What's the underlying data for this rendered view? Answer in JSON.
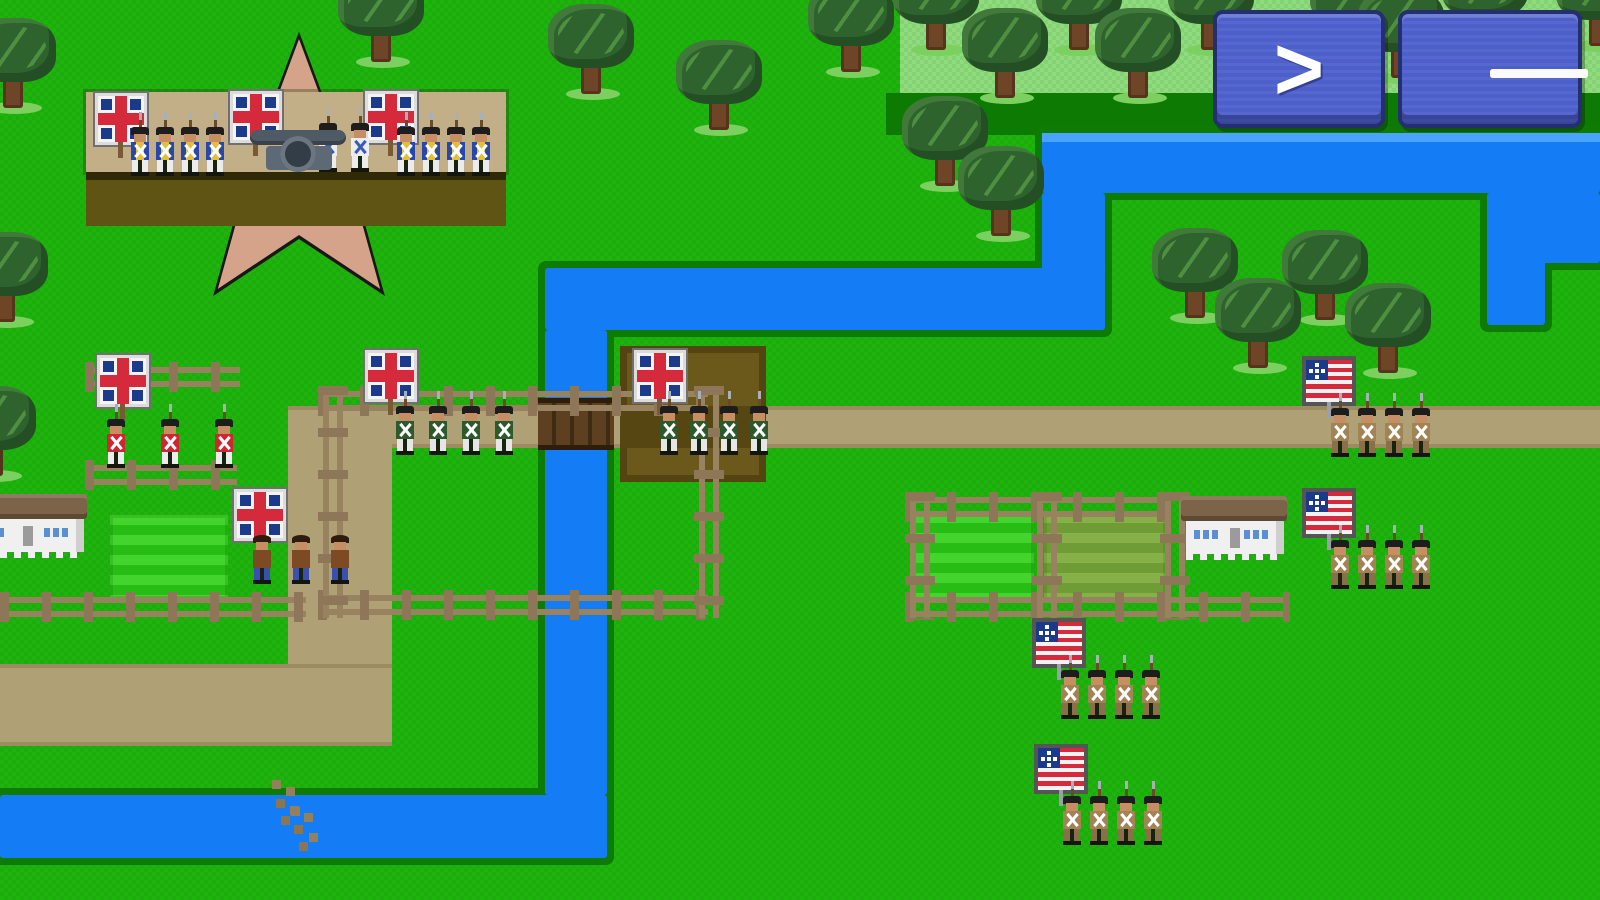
{
  "app": {
    "kind": "pixel-art-strategy-wargame",
    "view": "battle-map"
  },
  "hud": {
    "end_turn_button": {
      "icon": "chevron-right-icon",
      "glyph": ">"
    },
    "menu_button": {
      "icon": "hamburger-menu-icon",
      "bars": 3
    }
  },
  "colors": {
    "grass": "#1eb40d",
    "plateau": "#8fdb7d",
    "shadow": "#0d7a04",
    "water": "#147df5",
    "water_edge": "#0e7b05",
    "water_highlight": "#4aa4ff",
    "road": "#b0a075",
    "accent_button": "#4c5fca",
    "flag_red": "#d42a3c",
    "flag_blue": "#1b3a8c",
    "fort_star": "#d4a389",
    "fort_wall": "#c2ae87"
  },
  "map": {
    "width": 1600,
    "height": 900,
    "plateau": {
      "x": 900,
      "y": 0,
      "w": 700,
      "h": 93
    },
    "shadow_band": {
      "x": 886,
      "y": 93,
      "w": 714,
      "h": 42
    },
    "rivers": [
      {
        "x": 1042,
        "y": 133,
        "w": 558,
        "h": 60,
        "lip": true
      },
      {
        "x": 1487,
        "y": 193,
        "w": 58,
        "h": 132
      },
      {
        "x": 1540,
        "y": 193,
        "w": 60,
        "h": 70
      },
      {
        "x": 1042,
        "y": 193,
        "w": 63,
        "h": 137
      },
      {
        "x": 545,
        "y": 268,
        "w": 560,
        "h": 62
      },
      {
        "x": 545,
        "y": 330,
        "w": 62,
        "h": 465
      },
      {
        "x": 0,
        "y": 795,
        "w": 607,
        "h": 63
      }
    ],
    "roads": [
      {
        "x": 288,
        "y": 406,
        "w": 1312,
        "h": 42
      },
      {
        "x": 288,
        "y": 406,
        "w": 104,
        "h": 340
      },
      {
        "x": 0,
        "y": 664,
        "w": 392,
        "h": 82
      }
    ],
    "bridge": {
      "x": 538,
      "y": 398,
      "w": 76,
      "h": 52
    },
    "entrenchment": {
      "x": 620,
      "y": 346,
      "w": 146,
      "h": 136,
      "road_strip_y": 60,
      "road_strip_h": 42
    },
    "ford_marks": [
      {
        "x": 272,
        "y": 780
      },
      {
        "x": 290,
        "y": 806
      }
    ],
    "fields": [
      {
        "x": 110,
        "y": 515,
        "w": 118,
        "h": 84,
        "kind": "crop"
      },
      {
        "x": 912,
        "y": 513,
        "w": 122,
        "h": 88,
        "kind": "crop"
      },
      {
        "x": 1044,
        "y": 513,
        "w": 122,
        "h": 88,
        "kind": "olive"
      }
    ],
    "fences": [
      {
        "o": "h",
        "x": 85,
        "y": 362,
        "len": 155
      },
      {
        "o": "h",
        "x": 85,
        "y": 460,
        "len": 152
      },
      {
        "o": "h",
        "x": 0,
        "y": 592,
        "len": 306
      },
      {
        "o": "h",
        "x": 318,
        "y": 386,
        "len": 390
      },
      {
        "o": "h",
        "x": 318,
        "y": 590,
        "len": 390
      },
      {
        "o": "v",
        "x": 318,
        "y": 386,
        "len": 232
      },
      {
        "o": "v",
        "x": 694,
        "y": 386,
        "len": 232
      },
      {
        "o": "h",
        "x": 905,
        "y": 492,
        "len": 265
      },
      {
        "o": "h",
        "x": 905,
        "y": 592,
        "len": 385
      },
      {
        "o": "v",
        "x": 905,
        "y": 492,
        "len": 128
      },
      {
        "o": "v",
        "x": 1032,
        "y": 492,
        "len": 128
      },
      {
        "o": "v",
        "x": 1160,
        "y": 492,
        "len": 128
      }
    ],
    "houses": [
      {
        "x": -28,
        "y": 498,
        "w": 112,
        "h": 54,
        "roof": "#938672"
      },
      {
        "x": 1186,
        "y": 500,
        "w": 98,
        "h": 54,
        "roof": "#7d6347"
      }
    ],
    "trees": [
      [
        -30,
        18
      ],
      [
        338,
        -28
      ],
      [
        548,
        4
      ],
      [
        676,
        40
      ],
      [
        808,
        -18
      ],
      [
        893,
        -40
      ],
      [
        962,
        8
      ],
      [
        1036,
        -40
      ],
      [
        1095,
        8
      ],
      [
        1168,
        -40
      ],
      [
        1310,
        -38
      ],
      [
        1358,
        -12
      ],
      [
        1442,
        -46
      ],
      [
        1556,
        -44
      ],
      [
        902,
        96
      ],
      [
        958,
        146
      ],
      [
        1152,
        228
      ],
      [
        1282,
        230
      ],
      [
        1215,
        278
      ],
      [
        1345,
        283
      ],
      [
        -38,
        232
      ],
      [
        -50,
        386
      ]
    ],
    "fort": {
      "star_outline": {
        "x": 153,
        "y": 20,
        "size": 292
      },
      "star": {
        "x": 161,
        "y": 28,
        "size": 276
      },
      "band_top": {
        "x": 86,
        "y": 92,
        "w": 420,
        "h": 80
      },
      "band_line": {
        "x": 86,
        "y": 172,
        "w": 420,
        "h": 8
      },
      "band_low": {
        "x": 86,
        "y": 180,
        "w": 420,
        "h": 46
      },
      "flags": [
        [
          98,
          96
        ],
        [
          233,
          94
        ],
        [
          368,
          94
        ]
      ],
      "garrison_rows": [
        {
          "x": 128,
          "y": 112,
          "count": 4,
          "coat": "blue",
          "sp": 25
        },
        {
          "x": 394,
          "y": 112,
          "count": 4,
          "coat": "blue",
          "sp": 25
        }
      ],
      "crew": [
        {
          "x": 316,
          "y": 108,
          "coat": "white"
        },
        {
          "x": 348,
          "y": 108,
          "coat": "white"
        }
      ],
      "cannon": {
        "x": 250,
        "y": 124
      }
    },
    "units": [
      {
        "id": "british-redcoats",
        "faction": "british",
        "flag": "gb",
        "coat": "red",
        "count": 3,
        "x": 100,
        "y": 358,
        "sdx": 4,
        "sdy": 46,
        "sp": 54
      },
      {
        "id": "british-light-west",
        "faction": "british",
        "flag": "gb",
        "coat": "green",
        "count": 4,
        "x": 368,
        "y": 353,
        "sdx": 25,
        "sdy": 38,
        "sp": 33
      },
      {
        "id": "british-light-entrenched",
        "faction": "british",
        "flag": "gb",
        "coat": "green",
        "count": 4,
        "x": 637,
        "y": 353,
        "sdx": 20,
        "sdy": 38,
        "sp": 30
      },
      {
        "id": "british-native-allies",
        "faction": "british",
        "flag": "gb",
        "coat": "native",
        "count": 3,
        "x": 237,
        "y": 492,
        "sdx": 13,
        "sdy": 28,
        "sp": 39
      },
      {
        "id": "us-militia-road",
        "faction": "american",
        "flag": "us",
        "coat": "tan",
        "count": 4,
        "x": 1306,
        "y": 360,
        "sdx": 22,
        "sdy": 33,
        "sp": 27
      },
      {
        "id": "us-militia-farm",
        "faction": "american",
        "flag": "us",
        "coat": "tan",
        "count": 4,
        "x": 1306,
        "y": 492,
        "sdx": 22,
        "sdy": 33,
        "sp": 27
      },
      {
        "id": "us-militia-field",
        "faction": "american",
        "flag": "us",
        "coat": "tan",
        "count": 4,
        "x": 1036,
        "y": 622,
        "sdx": 22,
        "sdy": 33,
        "sp": 27
      },
      {
        "id": "us-militia-south",
        "faction": "american",
        "flag": "us",
        "coat": "tan",
        "count": 4,
        "x": 1038,
        "y": 748,
        "sdx": 22,
        "sdy": 33,
        "sp": 27
      }
    ]
  }
}
